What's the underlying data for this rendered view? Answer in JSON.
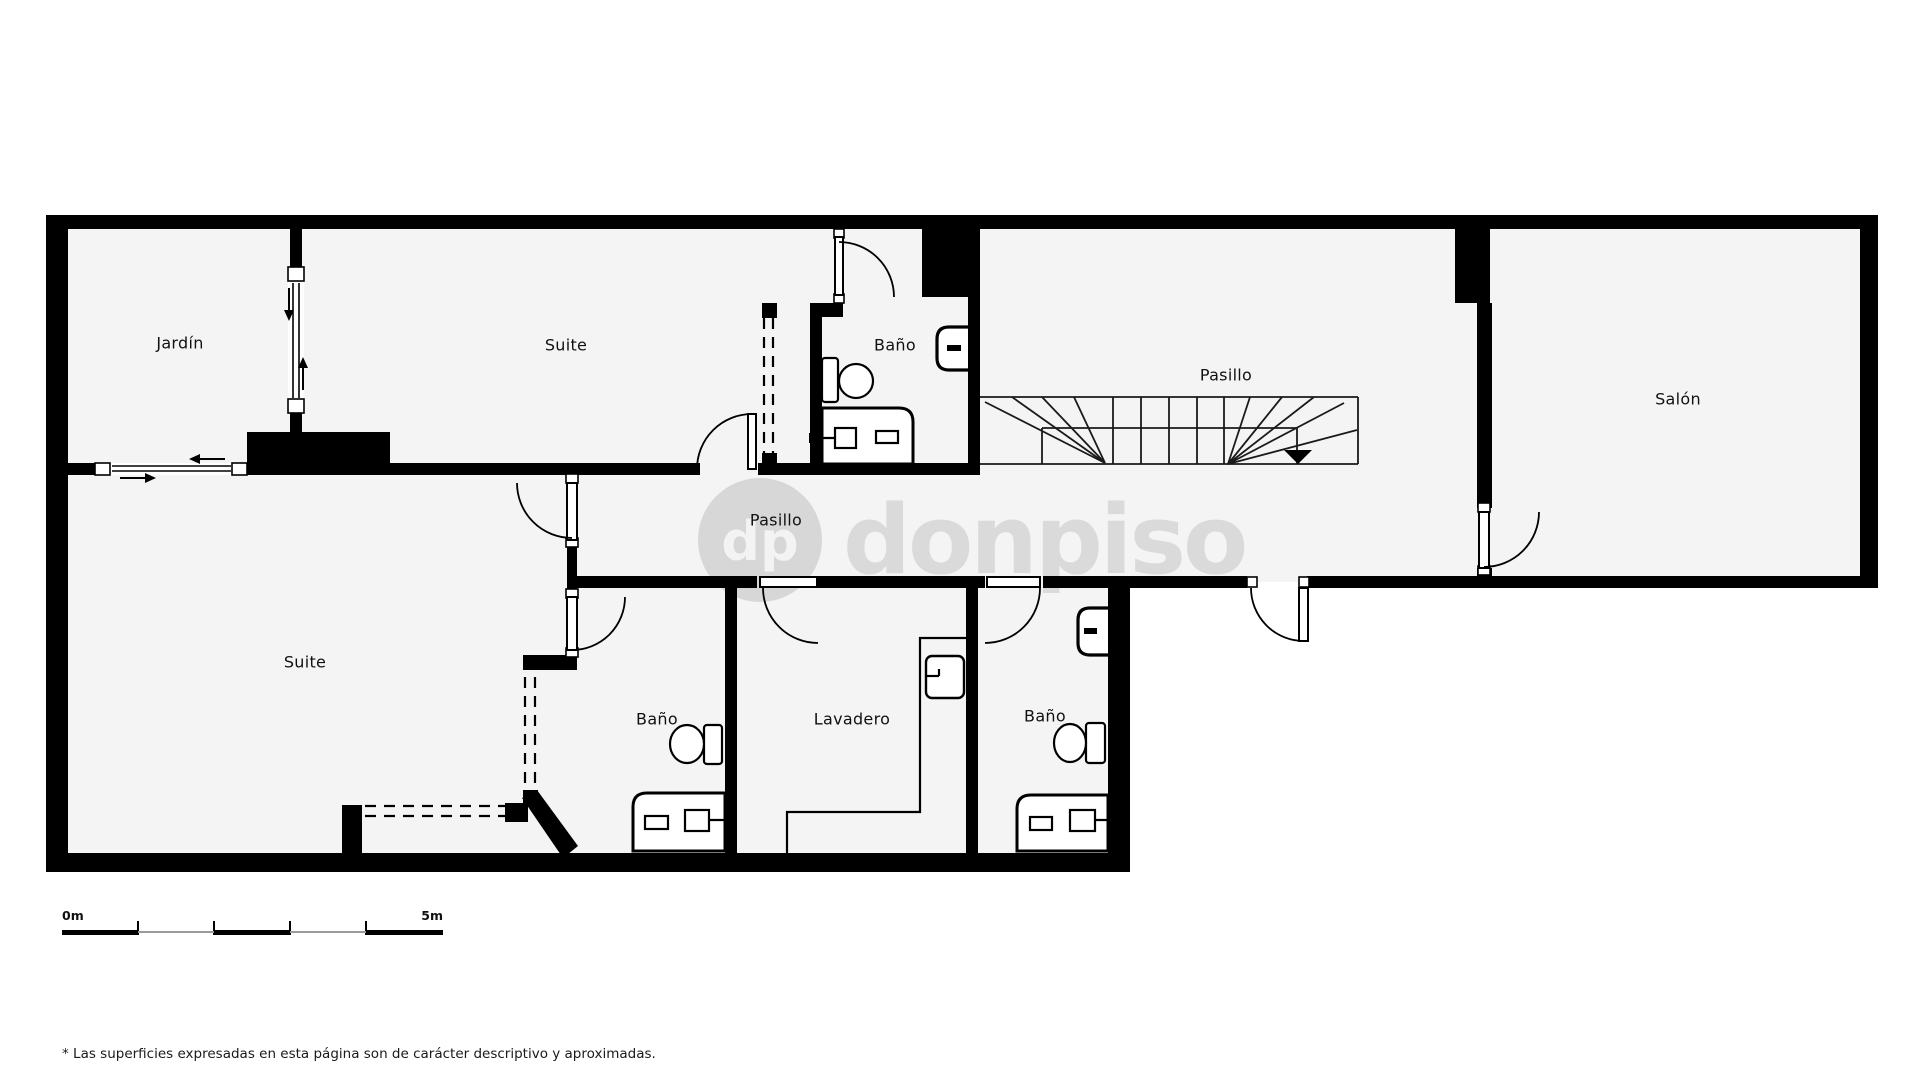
{
  "plan": {
    "rooms": [
      {
        "id": "jardin",
        "label": "Jardín",
        "x": 180,
        "y": 343
      },
      {
        "id": "suite-top",
        "label": "Suite",
        "x": 566,
        "y": 345
      },
      {
        "id": "bano-top",
        "label": "Baño",
        "x": 895,
        "y": 345
      },
      {
        "id": "pasillo-stairs",
        "label": "Pasillo",
        "x": 1226,
        "y": 375
      },
      {
        "id": "salon",
        "label": "Salón",
        "x": 1678,
        "y": 399
      },
      {
        "id": "pasillo-corridor",
        "label": "Pasillo",
        "x": 776,
        "y": 520
      },
      {
        "id": "suite-bottom",
        "label": "Suite",
        "x": 305,
        "y": 662
      },
      {
        "id": "bano-bottom-left",
        "label": "Baño",
        "x": 657,
        "y": 719
      },
      {
        "id": "lavadero",
        "label": "Lavadero",
        "x": 852,
        "y": 719
      },
      {
        "id": "bano-bottom-right",
        "label": "Baño",
        "x": 1045,
        "y": 716
      }
    ],
    "fixtures": [
      "toilet-icon",
      "sink-icon",
      "shower-icon",
      "washer-icon",
      "stairs",
      "door-swing",
      "sliding-door",
      "wardrobe-dashed"
    ]
  },
  "watermark": {
    "initials": "dp",
    "name": "donpiso"
  },
  "scale_bar": {
    "start": "0m",
    "end": "5m"
  },
  "footnote": "* Las superficies expresadas en esta página son de carácter descriptivo y aproximadas.",
  "colors": {
    "wall": "#000000",
    "floor": "#f4f4f4",
    "watermark_circle": "#d7d7d7",
    "watermark_text": "#dadada"
  }
}
